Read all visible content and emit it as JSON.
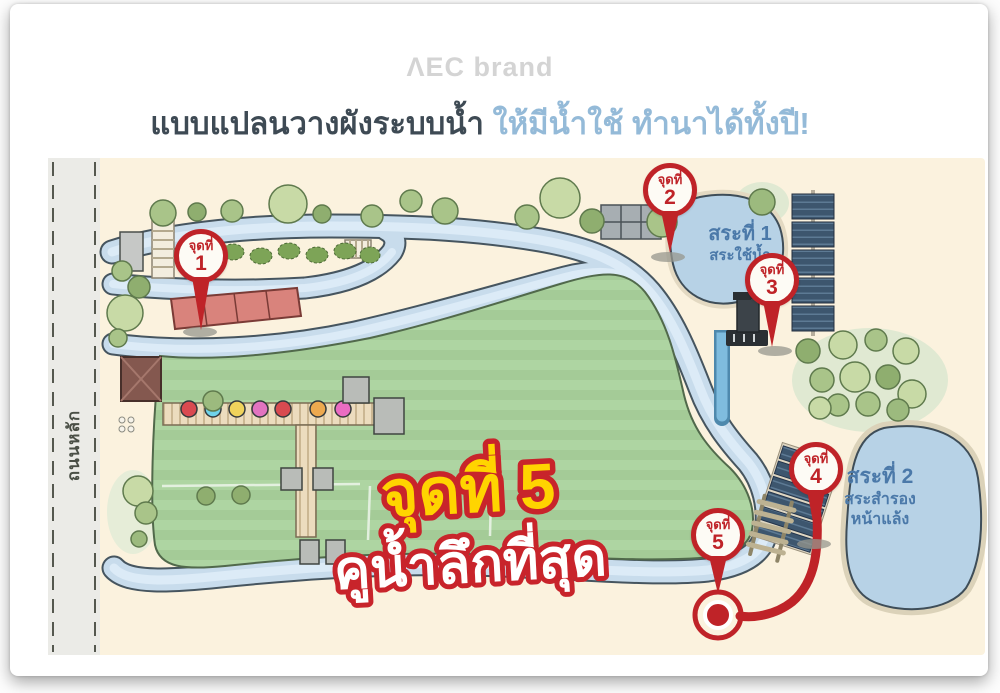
{
  "brand": "ΛEC brand",
  "title": {
    "main": "แบบแปลนวางผังระบบน้ำ",
    "highlight": "ให้มีน้ำใช้ ทำนาได้ทั้งปี!"
  },
  "road": {
    "label": "ถนนหลัก"
  },
  "markers": [
    {
      "label": "จุดที่",
      "number": "1"
    },
    {
      "label": "จุดที่",
      "number": "2"
    },
    {
      "label": "จุดที่",
      "number": "3"
    },
    {
      "label": "จุดที่",
      "number": "4"
    },
    {
      "label": "จุดที่",
      "number": "5"
    }
  ],
  "ponds": [
    {
      "name": "สระที่ 1",
      "sub1": "สระใช้น้ำ",
      "sub2": ""
    },
    {
      "name": "สระที่ 2",
      "sub1": "สระสำรอง",
      "sub2": "หน้าแล้ง"
    }
  ],
  "highlight_label": {
    "line1": "จุดที่ 5",
    "line2": "คูน้ำลึกที่สุด"
  },
  "colors": {
    "marker_red": "#bf2328",
    "highlight_yellow": "#ffd400",
    "highlight_outline": "#c8242b",
    "water_blue": "#c8dcec",
    "pond_blue": "#b7d2e6",
    "field_green": "#aed5a2",
    "title_dark": "#3e4a54",
    "title_blue": "#94bad8",
    "brand_gray": "#d4d4d4"
  }
}
